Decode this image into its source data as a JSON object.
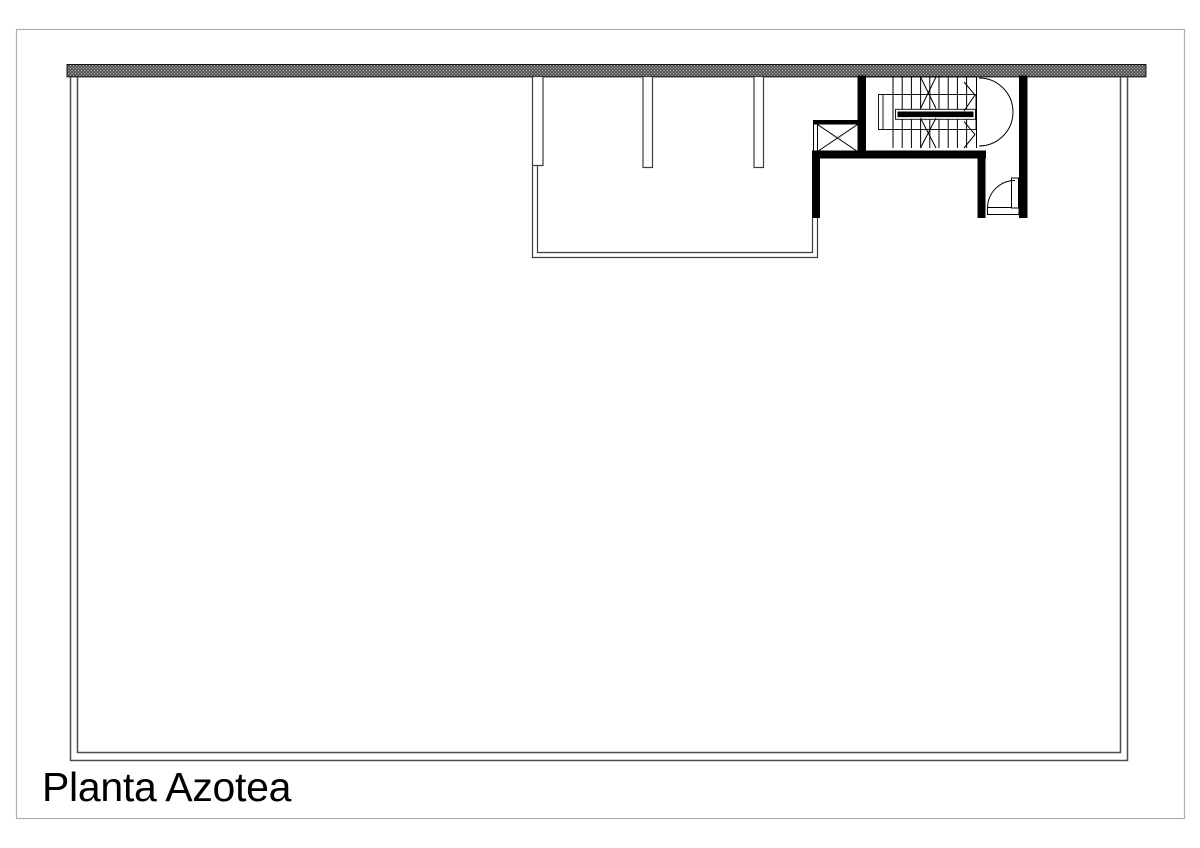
{
  "page": {
    "background": "#ffffff",
    "frame_color": "#b0b0b0"
  },
  "drawing": {
    "title": "Planta Azotea",
    "ink_color": "#000000",
    "wall_fill": "#000000",
    "thin_line_color": "#3d3d3d",
    "hatch_line_color": "#3a3a3a",
    "hatch_bg_color": "#c9c9c9"
  }
}
